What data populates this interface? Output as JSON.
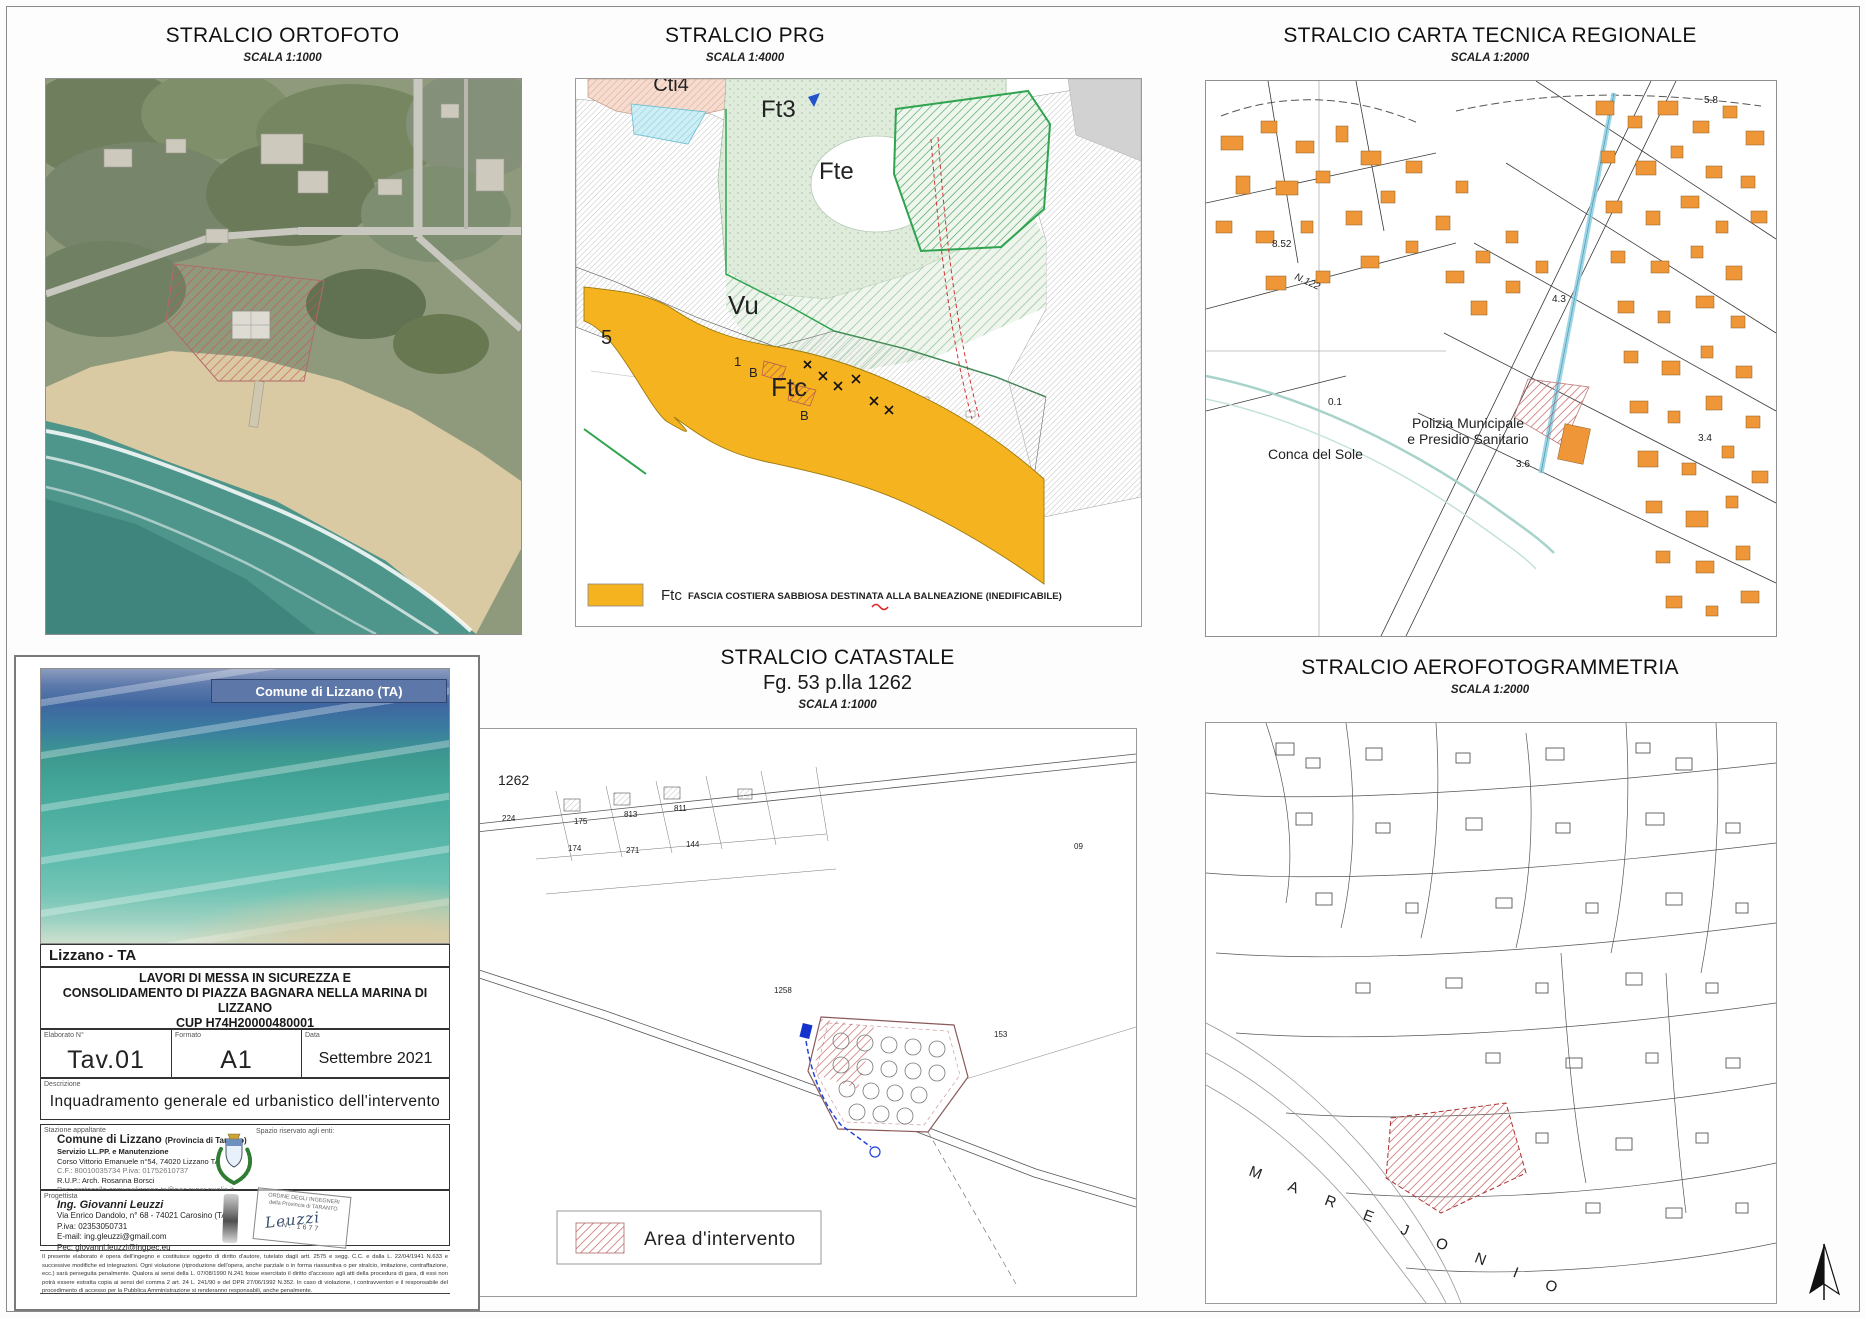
{
  "ortofoto": {
    "title": "STRALCIO ORTOFOTO",
    "scale": "SCALA 1:1000"
  },
  "prg": {
    "title": "STRALCIO PRG",
    "scale": "SCALA 1:4000",
    "zones": {
      "cti4": "Cti4",
      "ft3": "Ft3",
      "fte": "Fte",
      "vu": "Vu",
      "ftc": "Ftc",
      "five": "5",
      "one": "1",
      "b1": "B",
      "b2": "B"
    },
    "legend": {
      "code": "Ftc",
      "text": "FASCIA COSTIERA SABBIOSA DESTINATA ALLA BALNEAZIONE (INEDIFICABILE)",
      "swatch_color": "#F5B31F"
    }
  },
  "ctr": {
    "title": "STRALCIO CARTA TECNICA REGIONALE",
    "scale": "SCALA 1:2000",
    "building_color": "#EE9638",
    "labels": {
      "conca": "Conca del Sole",
      "polizia1": "Polizia Municipale",
      "polizia2": "e Presidio Sanitario",
      "n122": "N.122",
      "q58": "5.8",
      "q852": "8.52",
      "q43": "4.3",
      "q01": "0.1",
      "q36": "3.6",
      "q34": "3.4"
    }
  },
  "catastale": {
    "title": "STRALCIO CATASTALE",
    "subtitle": "Fg. 53 p.lla 1262",
    "scale": "SCALA 1:1000",
    "parcels": {
      "p1262": "1262",
      "p224": "224",
      "p175": "175",
      "p813": "813",
      "p811": "811",
      "p174": "174",
      "p271": "271",
      "p144": "144",
      "p1258": "1258",
      "p09": "09",
      "p153": "153"
    },
    "legend": {
      "label": "Area d'intervento"
    }
  },
  "aero": {
    "title": "STRALCIO AEROFOTOGRAMMETRIA",
    "scale": "SCALA 1:2000",
    "sea": "M A R E   J O N I O"
  },
  "titleblock": {
    "banner": "Comune di Lizzano (TA)",
    "location": "Lizzano - TA",
    "project": {
      "line1": "LAVORI DI MESSA IN SICUREZZA E",
      "line2": "CONSOLIDAMENTO DI PIAZZA BAGNARA NELLA MARINA DI LIZZANO",
      "cup": "CUP H74H20000480001",
      "phase": "PROGETTO DEFINITIVO/ESECUTIVO"
    },
    "fields": {
      "elaborato_label": "Elaborato N°",
      "elaborato": "Tav.01",
      "formato_label": "Formato",
      "formato": "A1",
      "data_label": "Data",
      "data": "Settembre 2021"
    },
    "descrizione_label": "Descrizione",
    "descrizione": "Inquadramento generale ed urbanistico dell'intervento",
    "stazione": {
      "label": "Stazione appaltante",
      "name": "Comune di Lizzano",
      "name_suffix": "(Provincia di Taranto)",
      "line2": "Servizio LL.PP. e Manutenzione",
      "line3": "Corso Vittorio Emanuele n°54, 74020 Lizzano TA",
      "line4": "C.F.: 80010035734  P.iva: 01752610737",
      "line5": "R.U.P.: Arch. Rosanna Borsci",
      "line6": "Pec: protocollo.comunelizzano.ta@pec.rupar.puglia.it",
      "spazio": "Spazio riservato agli enti:"
    },
    "progettista": {
      "label": "Progettista",
      "name": "Ing. Giovanni Leuzzi",
      "line2": "Via Enrico Dandolo, n° 68 - 74021 Carosino (TA)",
      "line3": "P.iva: 02353050731",
      "line4": "E-mail: ing.gleuzzi@gmail.com",
      "line5": "Pec: giovanni.leuzzi@ingpec.eu",
      "stamp_line1": "ORDINE DEGLI INGEGNERI",
      "stamp_line2": "della Provincia di TARANTO",
      "stamp_number": "N. 1677",
      "signature": "Leuzzi"
    },
    "fineprint": "Il presente elaborato è opera dell'ingegno e costituisce oggetto di diritto d'autore, tutelato dagli artt. 2575 e segg. C.C. e dalla L. 22/04/1941 N.633 e successive modifiche ed integrazioni. Ogni violazione (riproduzione dell'opera, anche parziale o in forma riassuntiva o per stralcio, imitazione, contraffazione, ecc.) sarà perseguita penalmente. Qualora ai sensi della L. 07/08/1990 N.241 fosse esercitato il diritto d'accesso agli atti della procedura di gara, di essi non potrà essere estratta copia ai sensi del comma 2 art. 24 L. 241/90 e del DPR 27/06/1992 N.352. In caso di violazione, i contravventori e il responsabile del procedimento di accesso per la Pubblica Amministrazione si renderanno responsabili, anche penalmente."
  }
}
